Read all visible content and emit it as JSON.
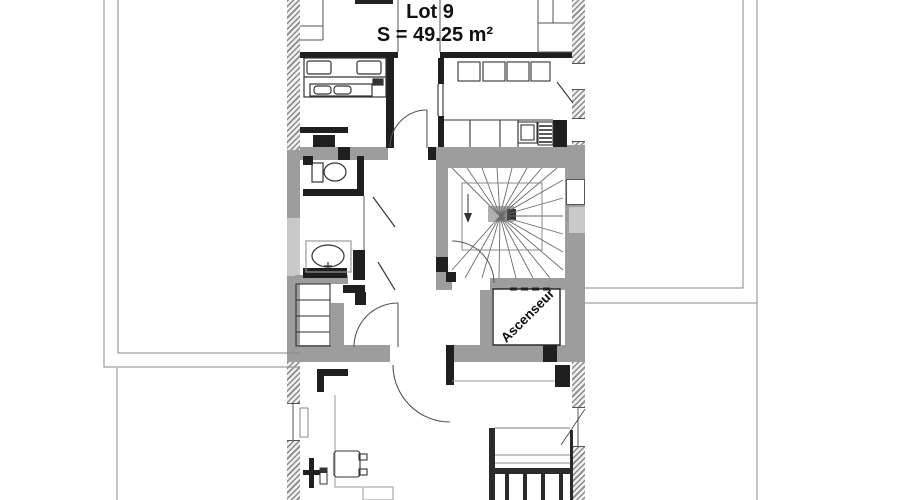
{
  "plan": {
    "lot_label": "Lot 9",
    "area_label": "S = 49.25 m²",
    "elevator_label": "Ascenseur"
  },
  "colors": {
    "background": "#ffffff",
    "wall_solid_gray": "#9d9d9d",
    "wall_light_gray": "#c9c9c9",
    "wall_black": "#1f1f1f",
    "hatch_gray": "#8a8a8a",
    "line_gray": "#555555",
    "text": "#111111"
  }
}
